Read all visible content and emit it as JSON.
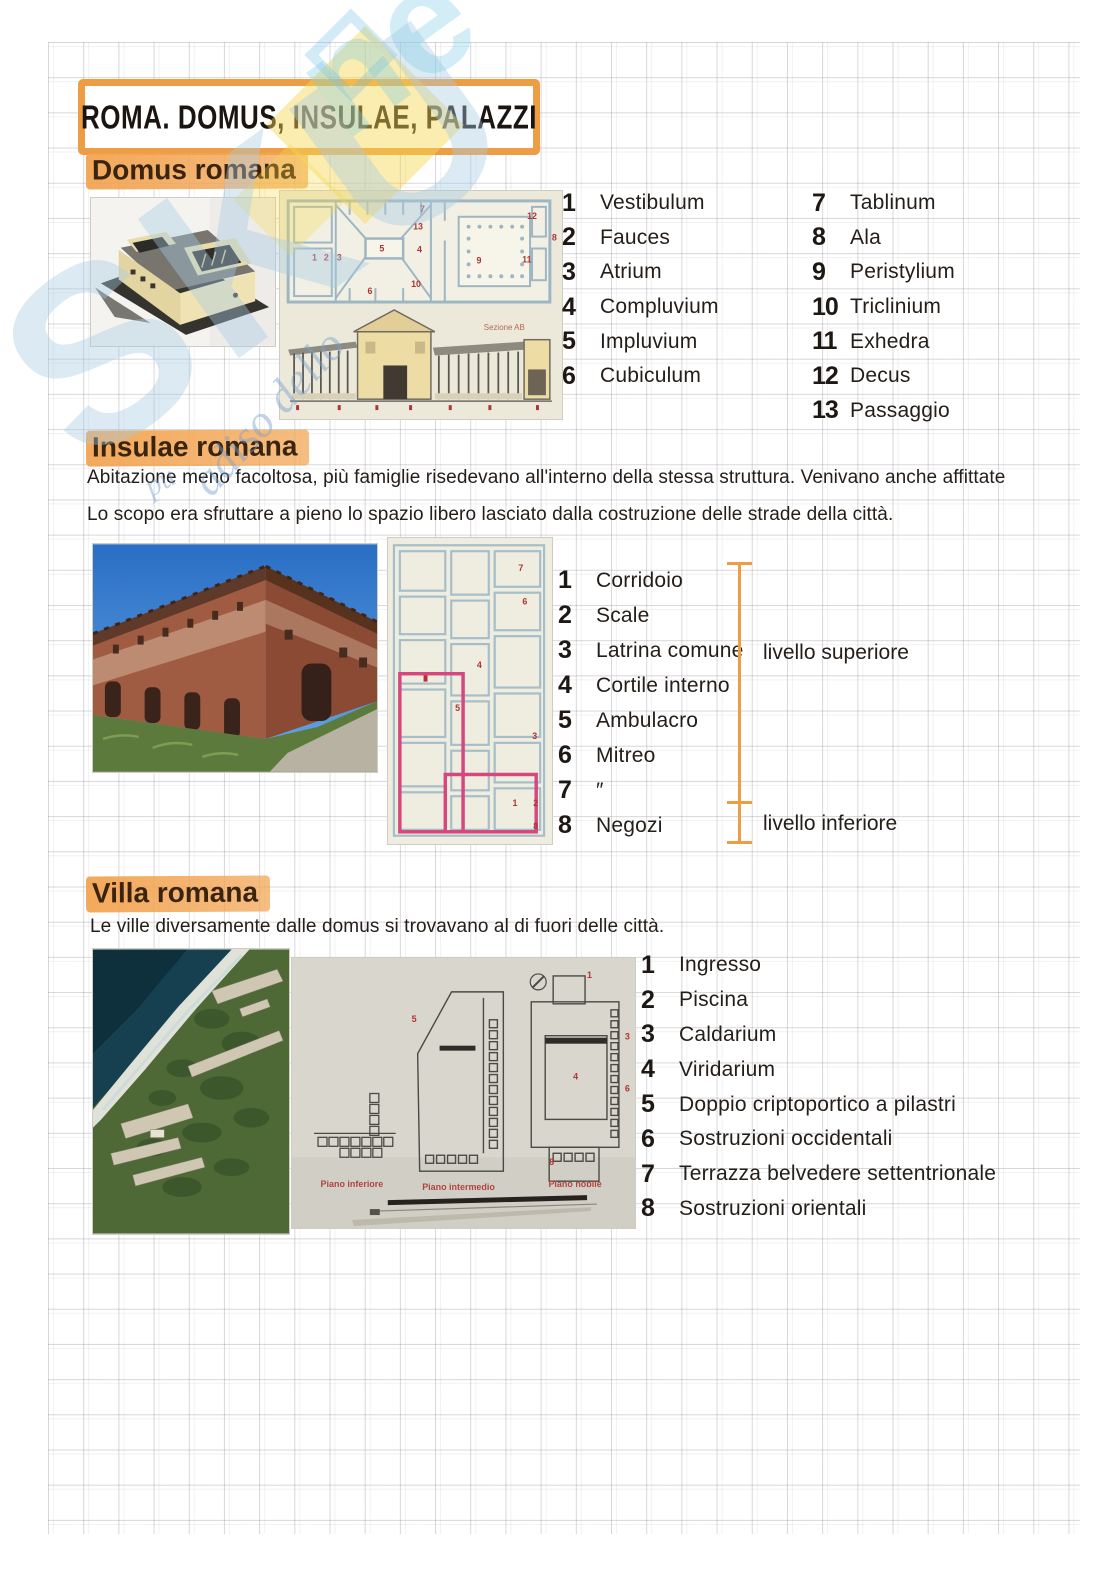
{
  "colors": {
    "accent_orange": "#ED9E45",
    "highlight_orange": "#F2A452",
    "ink": "#241D18",
    "plan_number_red": "#B13434",
    "pink_outline": "#D5477D",
    "watermark_blue": "#A9CBE4",
    "watermark_yellow": "#F7D850"
  },
  "page": {
    "title": "ROMA. DOMUS, INSULAE, PALAZZI"
  },
  "watermark": {
    "letters_main": "SKU",
    "letters_top": "ne",
    "script_fragment": "adiso dello",
    "script_fragment_small": "pu"
  },
  "domus": {
    "header": "Domus romana",
    "section_caption": "Sezione AB",
    "plan_digits": [
      "1",
      "2",
      "3",
      "4",
      "5",
      "6",
      "7",
      "8",
      "9",
      "10",
      "11",
      "12",
      "13"
    ],
    "list_col1": [
      {
        "n": "1",
        "label": "Vestibulum"
      },
      {
        "n": "2",
        "label": "Fauces"
      },
      {
        "n": "3",
        "label": "Atrium"
      },
      {
        "n": "4",
        "label": "Compluvium"
      },
      {
        "n": "5",
        "label": "Impluvium"
      },
      {
        "n": "6",
        "label": "Cubiculum"
      }
    ],
    "list_col2": [
      {
        "n": "7",
        "label": "Tablinum"
      },
      {
        "n": "8",
        "label": "Ala"
      },
      {
        "n": "9",
        "label": "Peristylium"
      },
      {
        "n": "10",
        "label": "Triclinium"
      },
      {
        "n": "11",
        "label": "Exhedra"
      },
      {
        "n": "12",
        "label": "Decus"
      },
      {
        "n": "13",
        "label": "Passaggio"
      }
    ]
  },
  "insulae": {
    "header": "Insulae romana",
    "paragraph_line1": "Abitazione meno facoltosa, più famiglie risedevano all'interno della stessa struttura. Venivano anche affittate",
    "paragraph_line2": "Lo scopo era sfruttare a pieno lo spazio libero lasciato dalla costruzione delle strade della città.",
    "plan_digits": [
      "7",
      "6",
      "4",
      "5",
      "3",
      "1",
      "2",
      "8"
    ],
    "list": [
      {
        "n": "1",
        "label": "Corridoio"
      },
      {
        "n": "2",
        "label": "Scale"
      },
      {
        "n": "3",
        "label": "Latrina comune"
      },
      {
        "n": "4",
        "label": "Cortile interno"
      },
      {
        "n": "5",
        "label": "Ambulacro"
      },
      {
        "n": "6",
        "label": "Mitreo"
      },
      {
        "n": "7",
        "label": "″"
      },
      {
        "n": "8",
        "label": "Negozi"
      }
    ],
    "level_upper": "livello superiore",
    "level_lower": "livello inferiore"
  },
  "villa": {
    "header": "Villa romana",
    "paragraph": "Le ville diversamente dalle domus si trovavano al di fuori delle città.",
    "plan_digits": [
      "1",
      "3",
      "4",
      "5",
      "6",
      "8"
    ],
    "plan_labels": [
      "Piano inferiore",
      "Piano intermedio",
      "Piano nobile"
    ],
    "list": [
      {
        "n": "1",
        "label": "Ingresso"
      },
      {
        "n": "2",
        "label": "Piscina"
      },
      {
        "n": "3",
        "label": "Caldarium"
      },
      {
        "n": "4",
        "label": "Viridarium"
      },
      {
        "n": "5",
        "label": "Doppio criptoportico a pilastri"
      },
      {
        "n": "6",
        "label": "Sostruzioni occidentali"
      },
      {
        "n": "7",
        "label": "Terrazza belvedere settentrionale"
      },
      {
        "n": "8",
        "label": "Sostruzioni orientali"
      }
    ]
  }
}
